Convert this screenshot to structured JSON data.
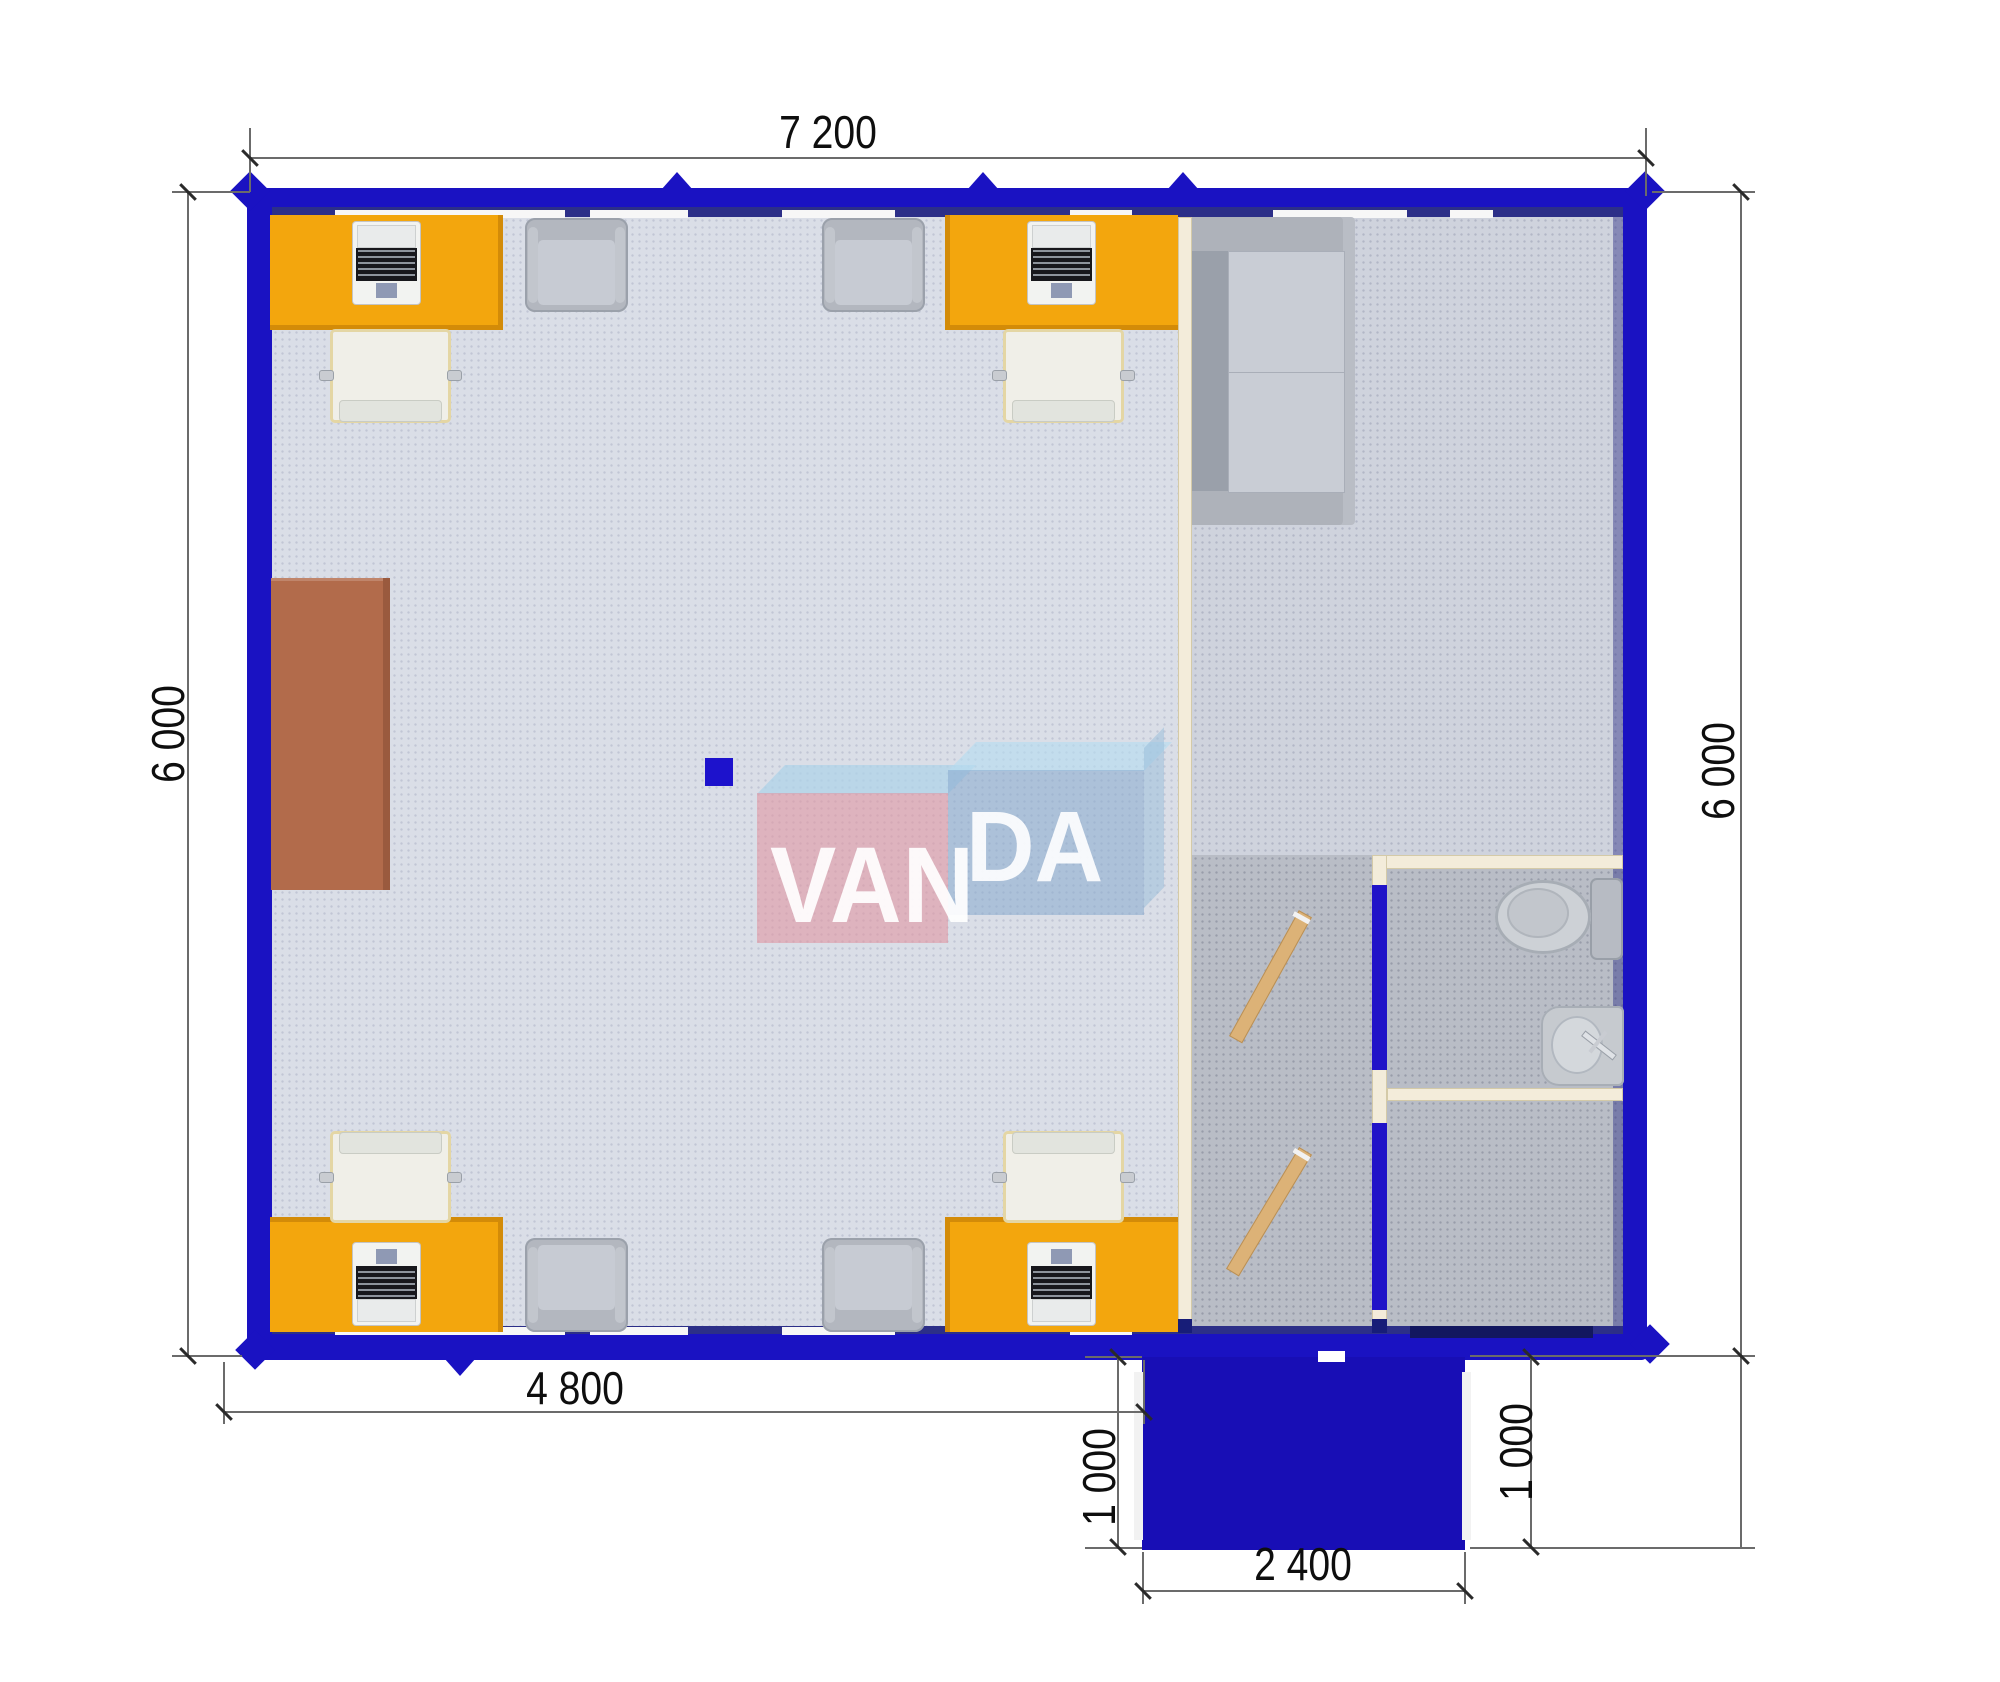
{
  "watermark": {
    "left": "VAN",
    "right": "DA"
  },
  "dimensions": {
    "overall_width_top": "7 200",
    "overall_height_left": "6 000",
    "overall_height_right": "6 000",
    "office_width_bottom": "4 800",
    "porch_depth_left": "1 000",
    "porch_depth_right": "1 000",
    "porch_width_bottom": "2 400"
  },
  "colors": {
    "wall_blue": "#1a12c2",
    "porch_blue": "#180eb5",
    "floor_office": "#dadee7",
    "floor_lounge": "#cfd3dd",
    "floor_wet_area": "#b9bdc6",
    "partition_cream": "#f3ecda",
    "desk_orange": "#f3a60d",
    "cabinet_brown": "#b26b4b",
    "interior_door_wood": "#dcb277",
    "furniture_gray": "#c0c4cc",
    "logo_pink": "#e49aa6",
    "logo_blue": "#8ab0d2"
  },
  "furniture": {
    "desks_with_laptops": 4,
    "office_chairs": 4,
    "visitor_armchairs": 4,
    "sofa": 1,
    "storage_cabinet": 1,
    "toilet": 1,
    "sink": 1,
    "interior_doors": 2,
    "entrance_door": 1
  }
}
